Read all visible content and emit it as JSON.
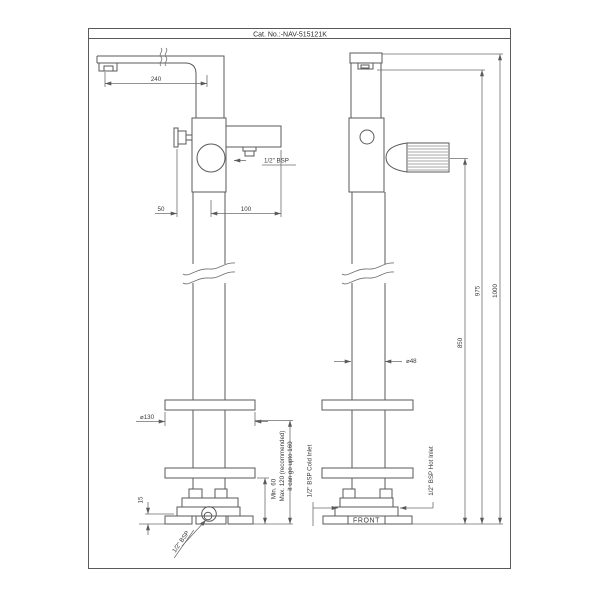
{
  "title_block": {
    "catalog_number": "Cat. No.:-NAV-515121K"
  },
  "front_view": {
    "dim_spout_reach": "240",
    "dim_handle_offset": "50",
    "dim_outlet_offset": "100",
    "shower_outlet_label": "1/2\" BSP",
    "dim_flange_diameter": "⌀130",
    "dim_base_plate_height": "15",
    "min_height_label": "Min. 60",
    "max_height_label_line1": "Max. 120 (recommended)",
    "max_height_label_line2": "it can go upto 160",
    "base_connection_label": "1/2\" BSP"
  },
  "side_view": {
    "dim_pillar_diameter": "⌀48",
    "dim_handle_height": "850",
    "dim_spout_underside_height": "975",
    "dim_overall_height": "1000",
    "cold_inlet_label": "1/2\" BSP Cold Inlet",
    "hot_inlet_label": "1/2\" BSP Hot Inlet",
    "front_marking": "FRONT"
  },
  "colors": {
    "line": "#5a5a5a",
    "text": "#3a3a3a",
    "background": "#ffffff"
  }
}
